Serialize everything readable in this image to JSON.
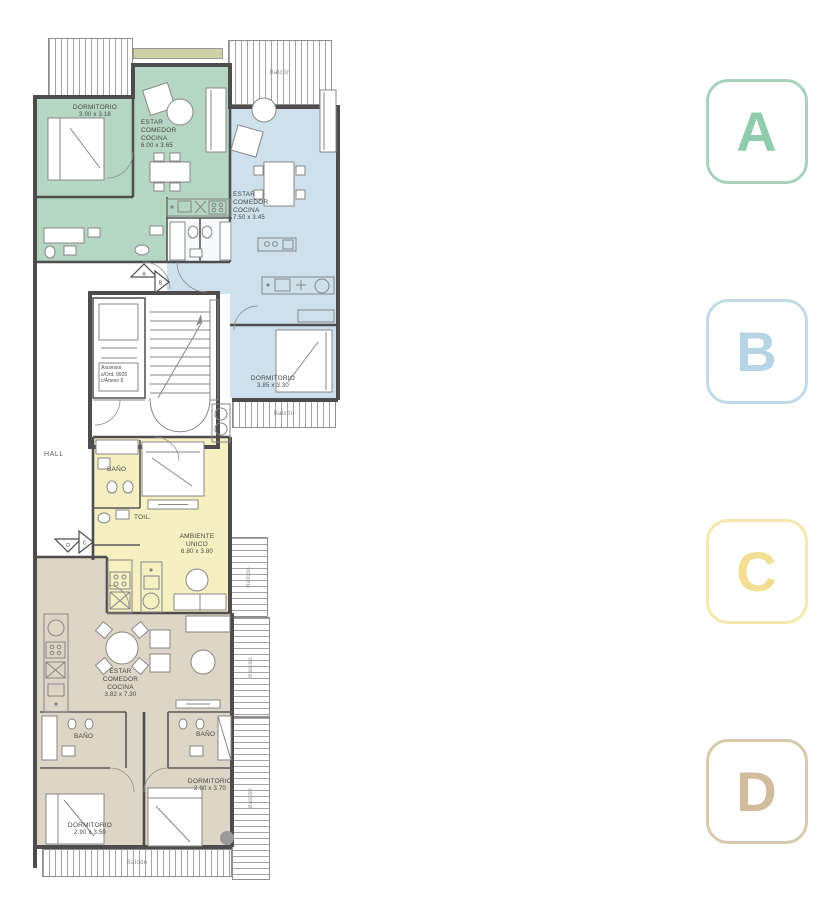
{
  "plan": {
    "colors": {
      "unit_a": "#b5d6c2",
      "unit_b": "#cde0eb",
      "unit_c": "#f6efc2",
      "unit_d": "#ddd5c5",
      "planter": "#cdd1a3"
    },
    "hall": "HALL",
    "elevator": {
      "line1": "Ascensor",
      "line2": "s/Ord. 9926",
      "line3": "c/Anexo 6"
    },
    "markers": {
      "a": "A",
      "b": "B",
      "c": "C",
      "d": "D"
    },
    "balconies": {
      "top": "Balcón",
      "b_bottom": "Balcón",
      "c_right": "Balcón",
      "d_right": "Balcón",
      "d_right_lower": "Balcón",
      "bottom": "Balcón"
    },
    "unit_a": {
      "bedroom": {
        "name": "DORMITORIO",
        "dims": "3.00 x 3.18"
      },
      "living": {
        "l1": "ESTAR",
        "l2": "COMEDOR",
        "l3": "COCINA",
        "dims": "6.00 x 3.65"
      }
    },
    "unit_b": {
      "living": {
        "l1": "ESTAR",
        "l2": "COMEDOR",
        "l3": "COCINA",
        "dims": "7.50 x 3.45"
      },
      "bedroom": {
        "name": "DORMITORIO",
        "dims": "3.85 x 3.30"
      }
    },
    "unit_c": {
      "bath": "BAÑO",
      "toilet": "TOIL.",
      "main": {
        "l1": "AMBIENTE",
        "l2": "UNICO",
        "dims": "6.80 x 3.80"
      }
    },
    "unit_d": {
      "living": {
        "l1": "ESTAR",
        "l2": "COMEDOR",
        "l3": "COCINA",
        "dims": "3.82 x 7.30"
      },
      "bath1": "BAÑO",
      "bath2": "BAÑO",
      "bedroom1": {
        "name": "DORMITORIO",
        "dims": "2.90 x 3.70"
      },
      "bedroom2": {
        "name": "DORMITORIO",
        "dims": "2.90 x 3.50"
      }
    }
  },
  "legend": {
    "badges": [
      {
        "letter": "A",
        "color_letter": "#90cbac",
        "color_border": "#a7d3bd"
      },
      {
        "letter": "B",
        "color_letter": "#b5d5e5",
        "color_border": "#c2dbe9"
      },
      {
        "letter": "C",
        "color_letter": "#f2df93",
        "color_border": "#f5e8ac"
      },
      {
        "letter": "D",
        "color_letter": "#d1bd9e",
        "color_border": "#d9c9ae"
      }
    ]
  }
}
